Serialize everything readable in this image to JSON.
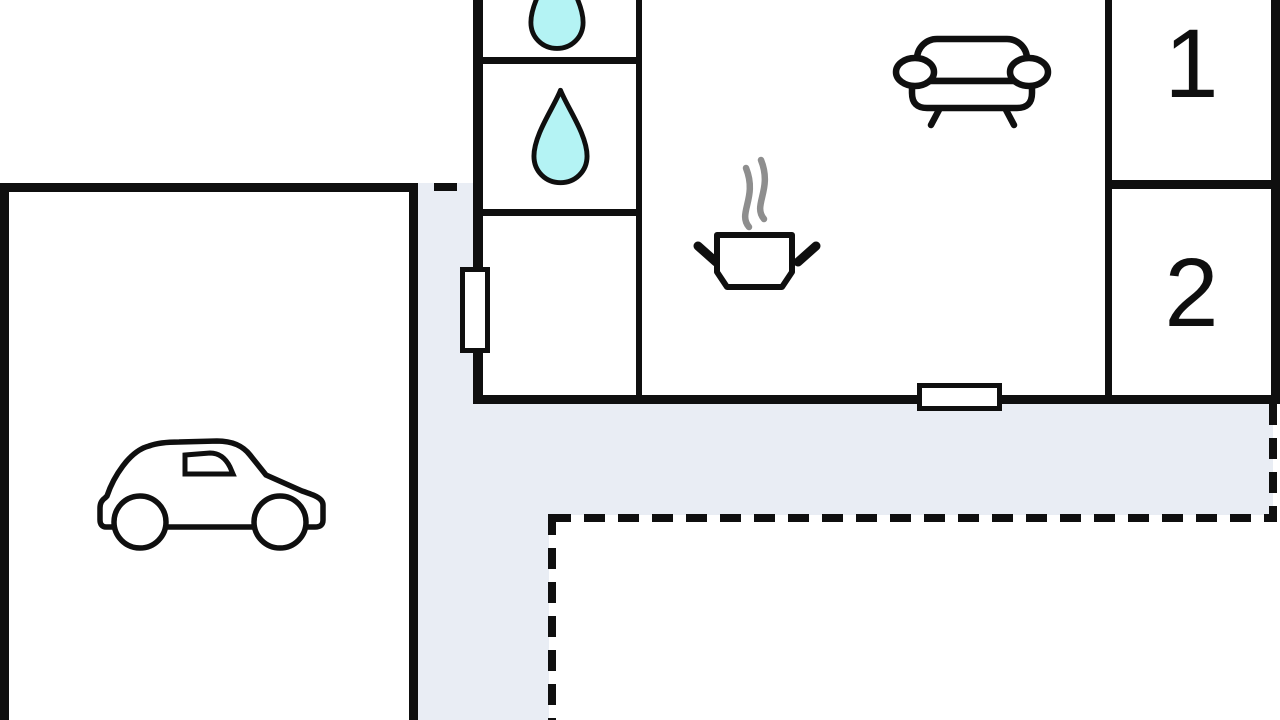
{
  "plan": {
    "type": "holiday-home-floor-plan",
    "rooms": {
      "bedroom1": {
        "label": "1"
      },
      "bedroom2": {
        "label": "2"
      }
    },
    "icons": {
      "garage": "car-icon",
      "bathroom_top": "water-drop-icon",
      "bathroom_middle": "water-drop-icon",
      "kitchen": "cooking-pot-icon",
      "living_room": "sofa-icon",
      "openings": "window-symbol",
      "outdoor": "terrace-area"
    }
  },
  "colors": {
    "wall": "#0f0f0f",
    "terrace": "#e9edf4",
    "water-drop": "#b4f3f4",
    "steam": "#8e8e8e",
    "floor": "#ffffff"
  }
}
